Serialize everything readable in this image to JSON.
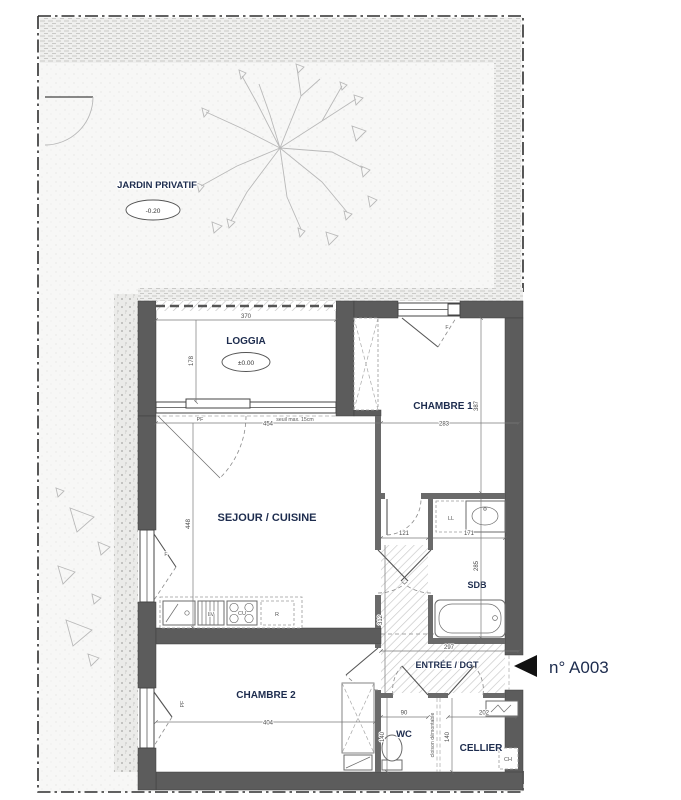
{
  "unit": {
    "arrow": "◀",
    "number": "n° A003"
  },
  "rooms": {
    "jardin": {
      "label": "JARDIN PRIVATIF",
      "level": "-0.20"
    },
    "loggia": {
      "label": "LOGGIA",
      "level": "±0.00"
    },
    "sejour": {
      "label": "SEJOUR / CUISINE"
    },
    "chambre1": {
      "label": "CHAMBRE 1"
    },
    "sdb": {
      "label": "SDB"
    },
    "entree": {
      "label": "ENTRÉE / DGT"
    },
    "chambre2": {
      "label": "CHAMBRE 2"
    },
    "wc": {
      "label": "WC"
    },
    "cellier": {
      "label": "CELLIER"
    }
  },
  "dimensions": {
    "loggia_width": "370",
    "loggia_depth": "178",
    "sejour_width": "454",
    "sejour_depth": "448",
    "chambre1_width": "283",
    "chambre1_depth": "387",
    "hall_width": "121",
    "sdb_width": "171",
    "sdb_depth": "285",
    "entree_width": "297",
    "entree_depth": "312",
    "chambre2_width": "404",
    "wc_width": "90",
    "wc_depth": "140",
    "cellier_width": "202",
    "cellier_depth": "140"
  },
  "annotations": {
    "loggia_window": "PF",
    "threshold_note": "seuil max. 15cm",
    "chambre1_window": "F",
    "sejour_window": "F",
    "chambre2_window": "PF",
    "washing_machine": "LL",
    "dishwasher": "LV",
    "cooktop": "CU",
    "fridge": "R",
    "water_heater": "CH",
    "partition_note": "cloison démontable"
  },
  "colors": {
    "wall": "#5c5c5c",
    "room_label": "#1d2c4e",
    "dimension_text": "#4a4a4a",
    "hatch": "#c6c6c6"
  }
}
